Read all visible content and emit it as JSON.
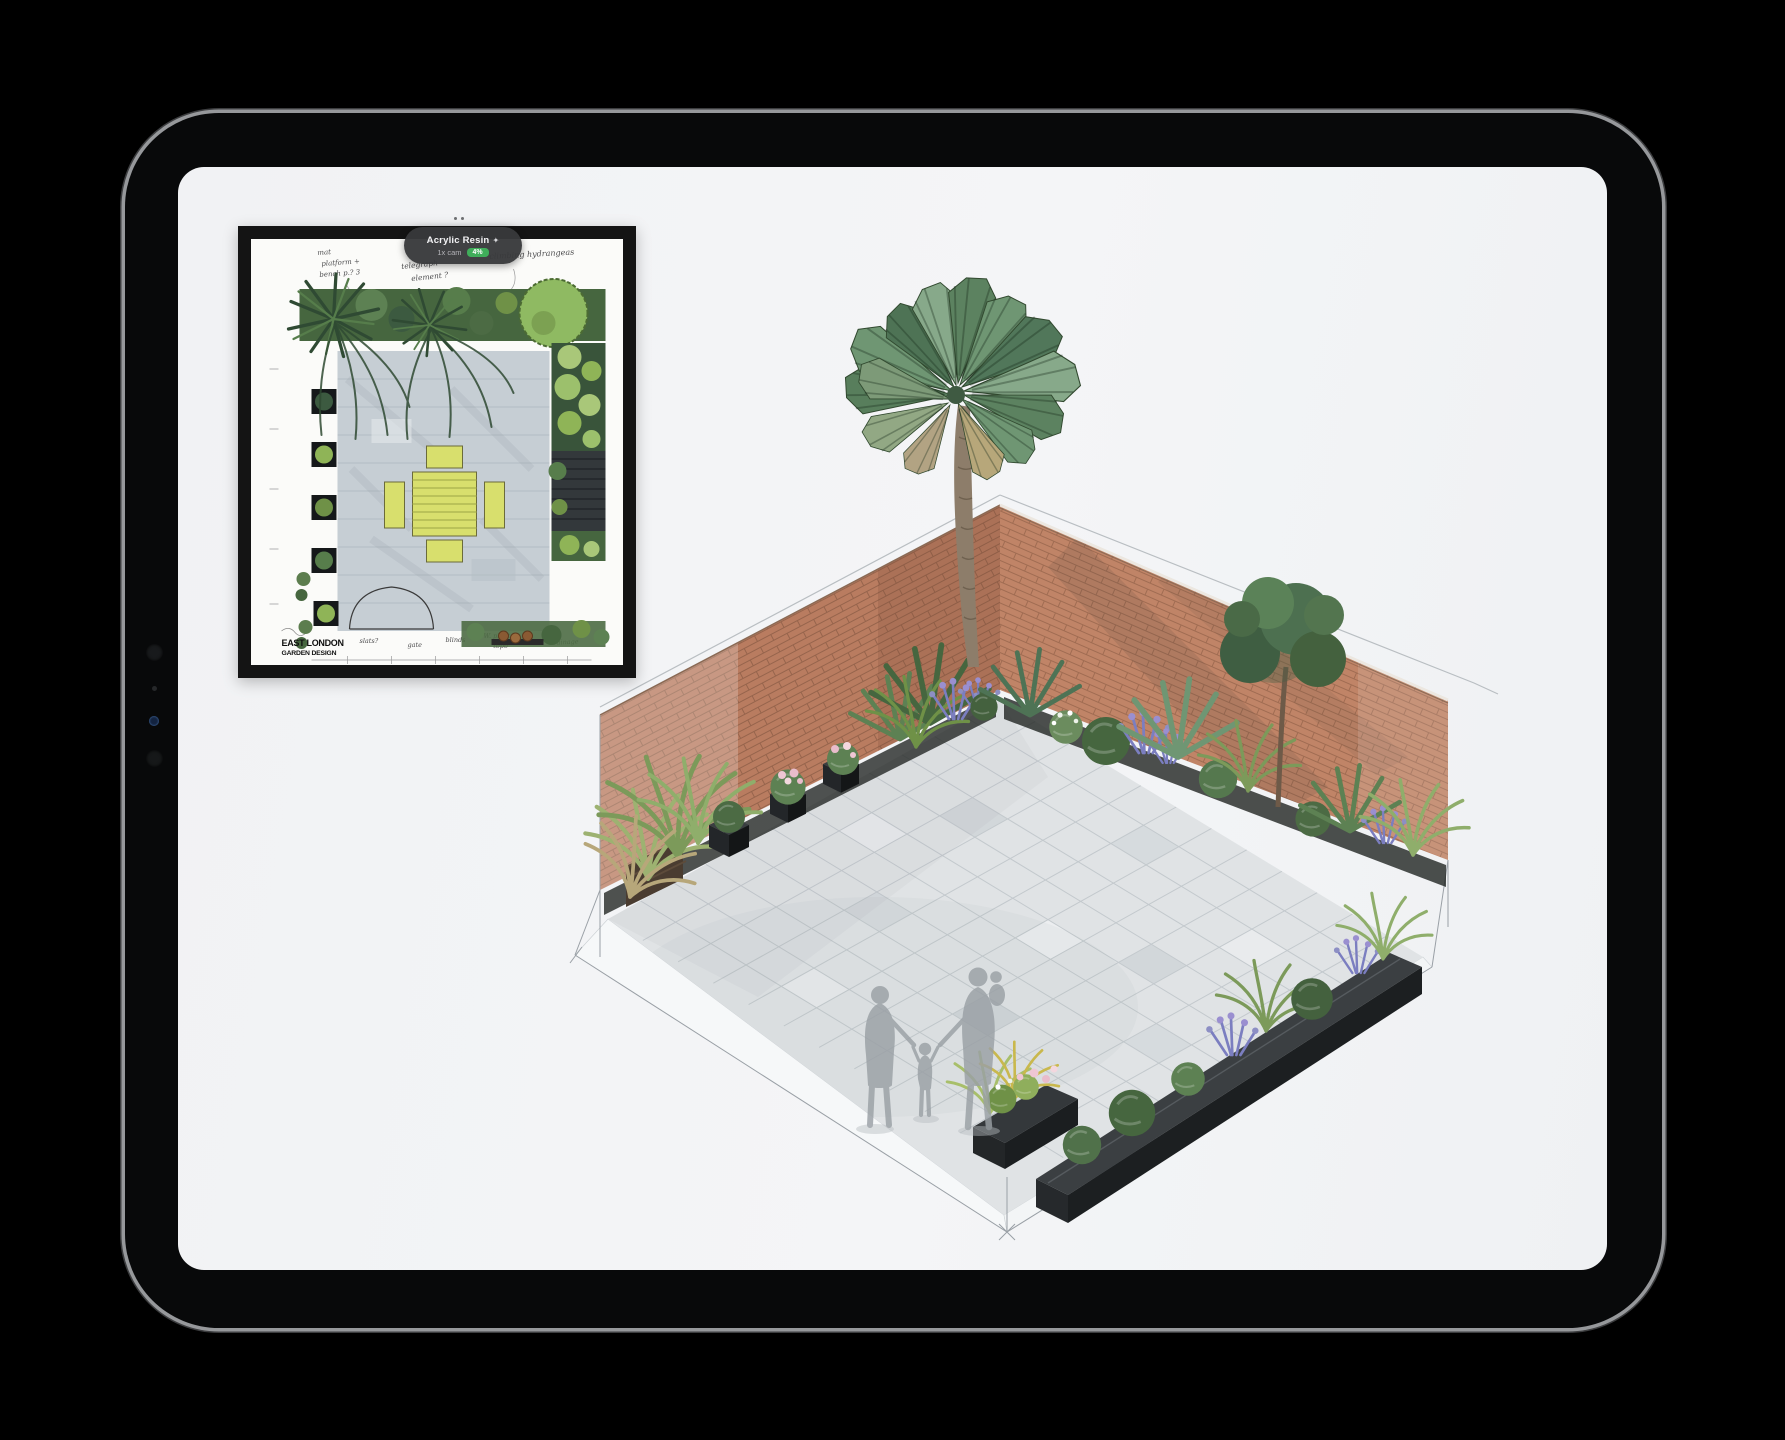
{
  "badge": {
    "title": "Acrylic Resin",
    "icon": "✦",
    "subtitle": "1x cam",
    "tag": "4%"
  },
  "inset_plan": {
    "title_line1": "EAST LONDON",
    "title_line2": "GARDEN DESIGN",
    "annotations": {
      "top_left1": "mat",
      "top_left2": "platform +",
      "top_left3": "bench p.? 3",
      "top_mid1": "telegraph",
      "top_mid2": "element ?",
      "top_right": "climbing hydrangeas",
      "bottom1": "slats?",
      "bottom2": "gate",
      "bottom3": "blinds",
      "bottom4": "W. plant",
      "bottom5": "'topo'",
      "bottom6": "drainage"
    }
  },
  "scene": {
    "description_tags": [
      "brick corner walls",
      "fan palm",
      "stone paving",
      "family silhouettes",
      "planter boxes"
    ]
  },
  "colors": {
    "background": "#000000",
    "screen": "#f3f4f6",
    "brick_left": "#b97c60",
    "brick_right": "#c08467",
    "mortar": "#96644c",
    "paving": "#e0e3e5",
    "planter_dark": "#26292b",
    "leaf_dark": "#3c5a40",
    "leaf_mid": "#5d8153",
    "leaf_light": "#85a96e",
    "lavender": "#8d8fc4",
    "pink": "#e9bccb",
    "silhouette": "#9aa0a5",
    "accent_green": "#3fae5a",
    "sketch_line": "#9aa0a6"
  }
}
